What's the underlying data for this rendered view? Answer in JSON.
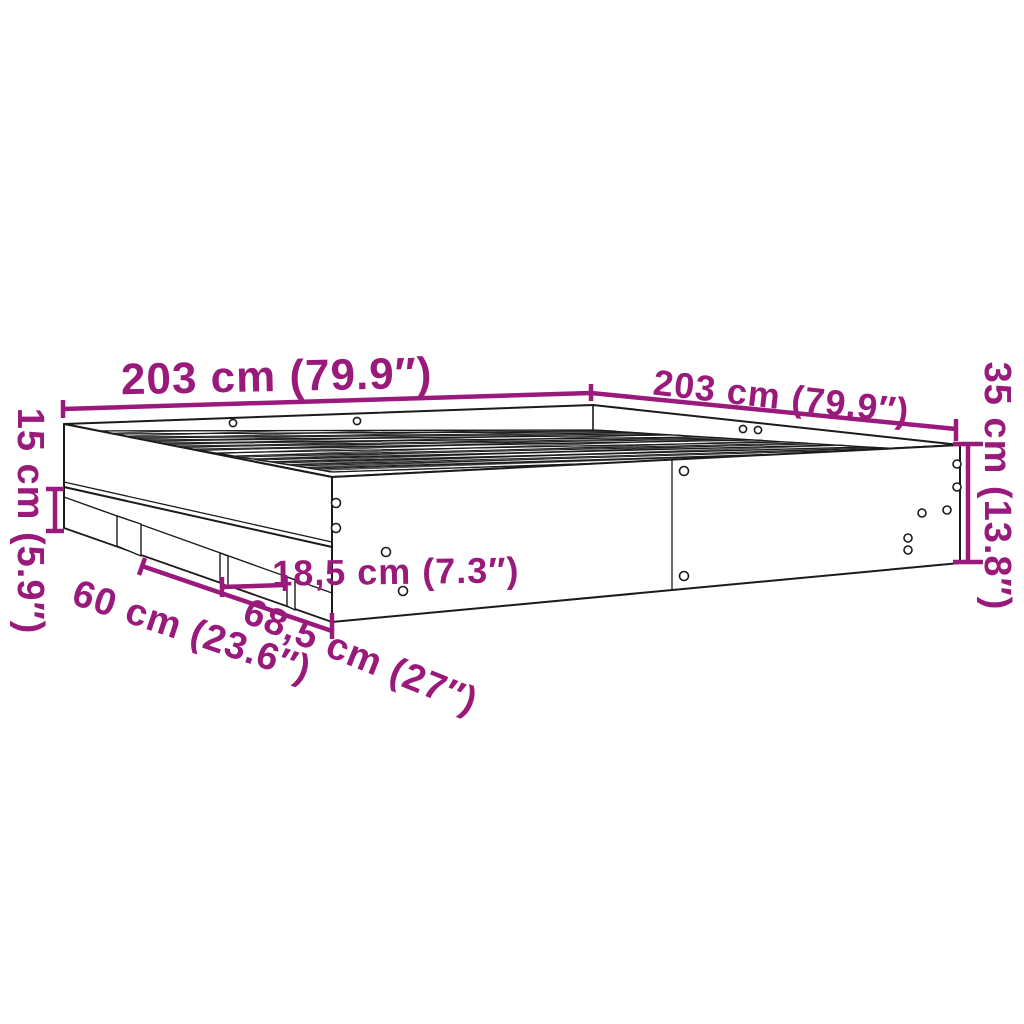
{
  "diagram": {
    "type": "furniture-dimension-drawing",
    "subject": "bed frame with slatted base and plinth storage compartments",
    "colors": {
      "background": "#ffffff",
      "outline": "#1b1b1b",
      "dimension_accent": "#9a1a7b"
    },
    "labels": {
      "length_top_left": "203 cm (79.9″)",
      "width_top_right": "203 cm (79.9″)",
      "height_right": "35 cm (13.8″)",
      "plinth_height_left": "15 cm (5.9″)",
      "compartment_width_60": "60 cm (23.6″)",
      "compartment_width_685": "68,5 cm (27″)",
      "compartment_width_185": "18,5 cm (7.3″)"
    }
  }
}
